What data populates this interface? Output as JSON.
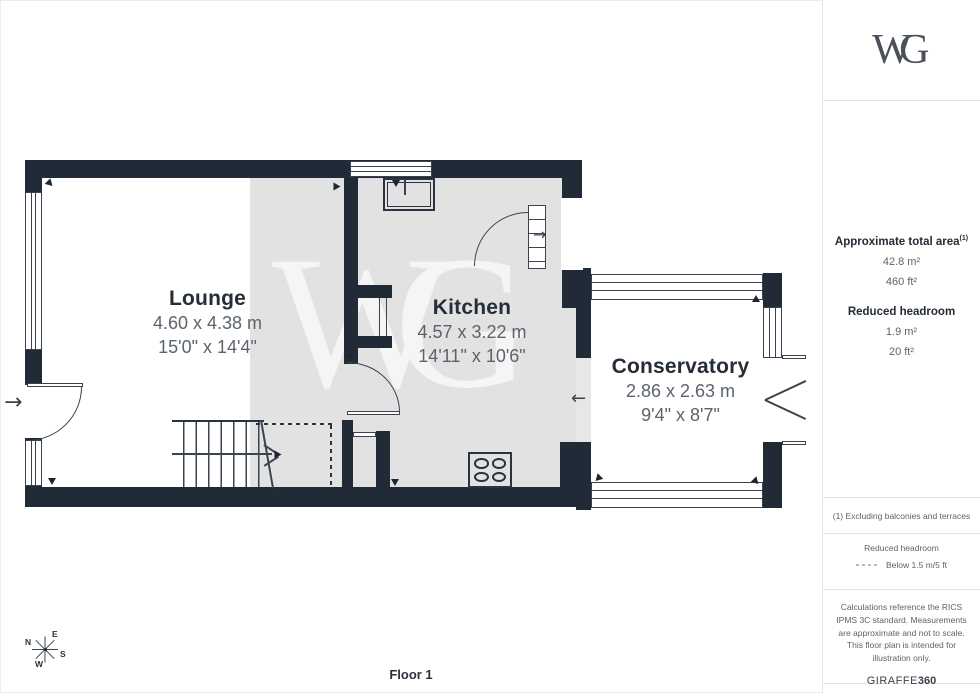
{
  "branding": {
    "logo": "WG",
    "watermark": "WG",
    "giraffe": "GIRAFFE",
    "giraffe_suffix": "360"
  },
  "sidebar": {
    "area_title": "Approximate total area",
    "area_sup": "(1)",
    "area_m2": "42.8 m²",
    "area_ft2": "460 ft²",
    "headroom_title": "Reduced headroom",
    "headroom_m2": "1.9 m²",
    "headroom_ft2": "20 ft²",
    "note": "(1) Excluding balconies and terraces",
    "legend_title": "Reduced headroom",
    "legend_value": "Below 1.5 m/5 ft",
    "disclaimer": "Calculations reference the RICS IPMS 3C standard. Measurements are approximate and not to scale. This floor plan is intended for illustration only."
  },
  "rooms": [
    {
      "name": "Lounge",
      "metric": "4.60 x 4.38 m",
      "imperial": "15'0\" x 14'4\""
    },
    {
      "name": "Kitchen",
      "metric": "4.57 x 3.22 m",
      "imperial": "14'11\" x 10'6\""
    },
    {
      "name": "Conservatory",
      "metric": "2.86 x 2.63 m",
      "imperial": "9'4\" x 8'7\""
    }
  ],
  "floor": {
    "label": "Floor 1"
  },
  "compass": {
    "n": "N",
    "e": "E",
    "s": "S",
    "w": "W"
  },
  "colors": {
    "wall": "#212a37",
    "floor_shading": "#e2e2e2"
  }
}
